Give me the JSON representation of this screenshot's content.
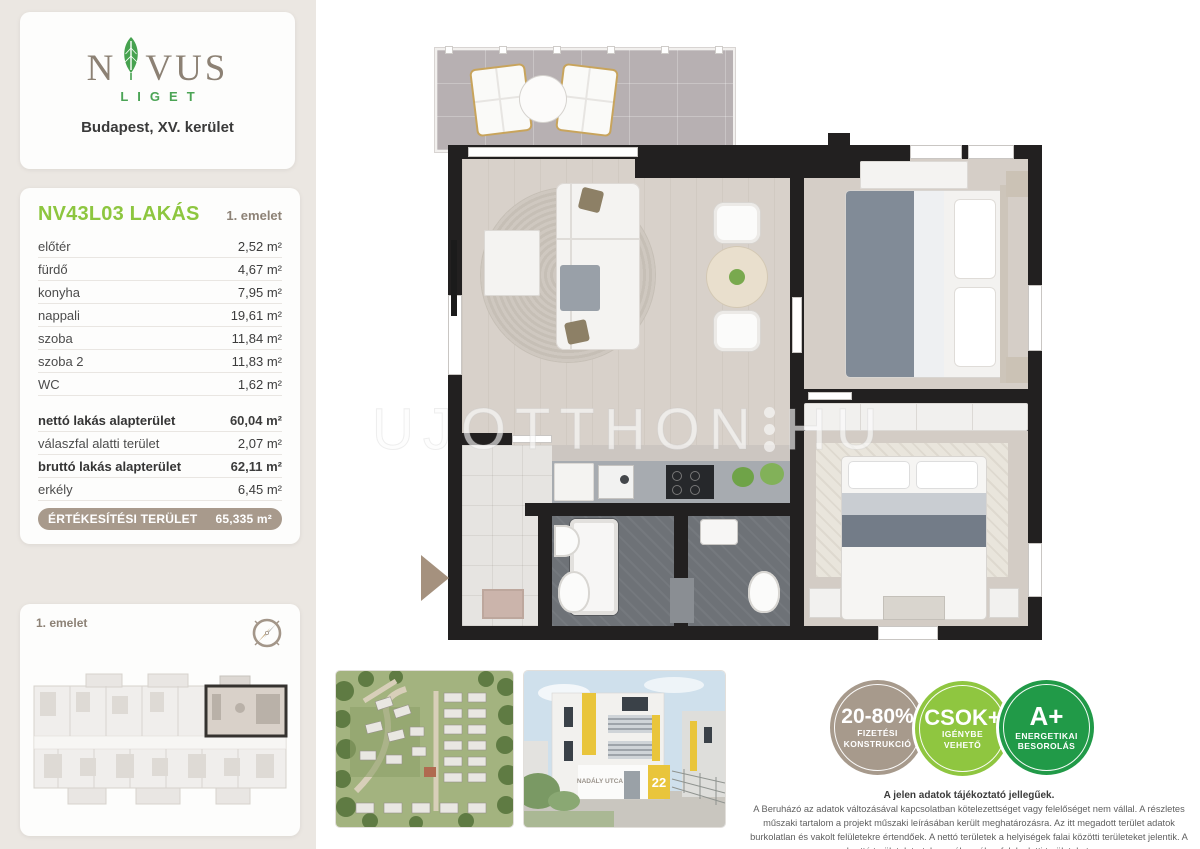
{
  "logo": {
    "brand_n": "N",
    "brand_rest": "VUS",
    "sub": "LIGET",
    "location": "Budapest, XV. kerület"
  },
  "unit": {
    "title": "NV43L03 LAKÁS",
    "floor": "1. emelet",
    "rooms": [
      {
        "label": "előtér",
        "value": "2,52 m²"
      },
      {
        "label": "fürdő",
        "value": "4,67 m²"
      },
      {
        "label": "konyha",
        "value": "7,95 m²"
      },
      {
        "label": "nappali",
        "value": "19,61 m²"
      },
      {
        "label": "szoba",
        "value": "11,84 m²"
      },
      {
        "label": "szoba 2",
        "value": "11,83 m²"
      },
      {
        "label": "WC",
        "value": "1,62 m²"
      }
    ],
    "summary": [
      {
        "label": "nettó lakás alapterület",
        "value": "60,04 m²"
      },
      {
        "label": "válaszfal alatti terület",
        "value": "2,07 m²"
      },
      {
        "label": "bruttó lakás alapterület",
        "value": "62,11 m²"
      },
      {
        "label": "erkély",
        "value": "6,45 m²"
      }
    ],
    "sale": {
      "label": "ÉRTÉKESÍTÉSI TERÜLET",
      "value": "65,335 m²"
    }
  },
  "mini_plan": {
    "label": "1. emelet"
  },
  "watermark": {
    "left": "UJOTTHON",
    "right": "HU"
  },
  "building_photo": {
    "street_sign": "NADÁLY UTCA",
    "number": "22"
  },
  "badges": [
    {
      "big": "20-80%",
      "line1": "FIZETÉSI",
      "line2": "KONSTRUKCIÓ",
      "color": "#a79a8c"
    },
    {
      "big": "CSOK+",
      "line1": "IGÉNYBE",
      "line2": "VEHETŐ",
      "color": "#8fc640"
    },
    {
      "big": "A+",
      "line1": "ENERGETIKAI",
      "line2": "BESOROLÁS",
      "color": "#219a48"
    }
  ],
  "disclaimer": {
    "title": "A jelen adatok tájékoztató jellegűek.",
    "body": "A Beruházó az adatok változásával kapcsolatban kötelezettséget vagy felelőséget nem vállal. A részletes műszaki tartalom a projekt műszaki leírásában került meghatározásra. Az itt megadott terület adatok burkolatlan és vakolt felületekre értendőek. A nettó területek a helyiségek falai közötti területeket jelentik. A bruttó területek tartalmazzák a válaszfalak alatti területeket."
  }
}
